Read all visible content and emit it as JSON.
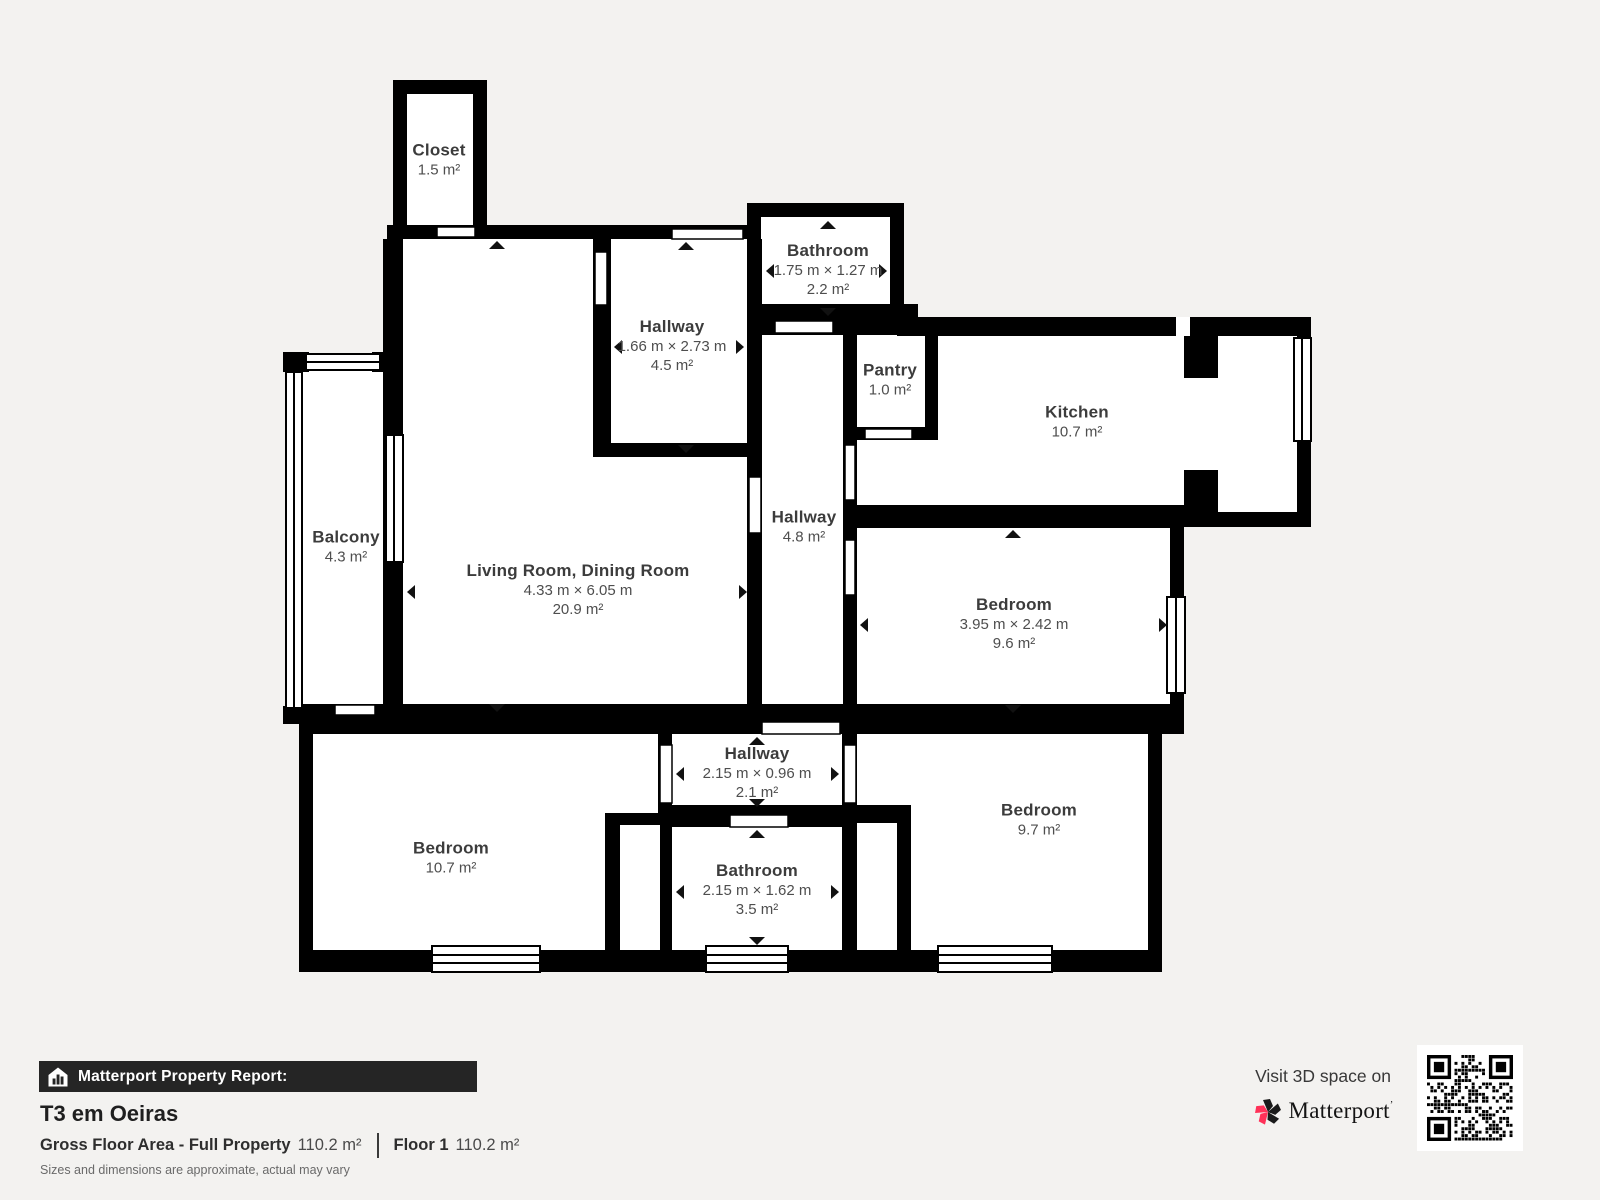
{
  "colors": {
    "background": "#f3f2f0",
    "wall": "#000000",
    "room_fill": "#ffffff",
    "bar_background": "#252525",
    "accent_pink": "#ff3158"
  },
  "plan": {
    "rooms": [
      {
        "name": "Closet",
        "area": "1.5 m²"
      },
      {
        "name": "Bathroom",
        "dims": "1.75 m × 1.27 m",
        "area": "2.2 m²"
      },
      {
        "name": "Hallway",
        "dims": "1.66 m × 2.73 m",
        "area": "4.5 m²"
      },
      {
        "name": "Pantry",
        "area": "1.0 m²"
      },
      {
        "name": "Kitchen",
        "area": "10.7 m²"
      },
      {
        "name": "Balcony",
        "area": "4.3 m²"
      },
      {
        "name": "Living Room, Dining Room",
        "dims": "4.33 m × 6.05 m",
        "area": "20.9 m²"
      },
      {
        "name": "Hallway",
        "area": "4.8 m²"
      },
      {
        "name": "Bedroom",
        "dims": "3.95 m × 2.42 m",
        "area": "9.6 m²"
      },
      {
        "name": "Hallway",
        "dims": "2.15 m × 0.96 m",
        "area": "2.1 m²"
      },
      {
        "name": "Bedroom",
        "area": "10.7 m²"
      },
      {
        "name": "Bathroom",
        "dims": "2.15 m × 1.62 m",
        "area": "3.5 m²"
      },
      {
        "name": "Bedroom",
        "area": "9.7 m²"
      }
    ]
  },
  "footer": {
    "report_label": "Matterport Property Report:",
    "title": "T3 em Oeiras",
    "gross_label": "Gross Floor Area - Full Property",
    "gross_value": "110.2 m²",
    "floor_label": "Floor 1",
    "floor_value": "110.2 m²",
    "disclaimer": "Sizes and dimensions are approximate, actual may vary"
  },
  "visit": {
    "label": "Visit 3D space on",
    "brand": "Matterport"
  }
}
